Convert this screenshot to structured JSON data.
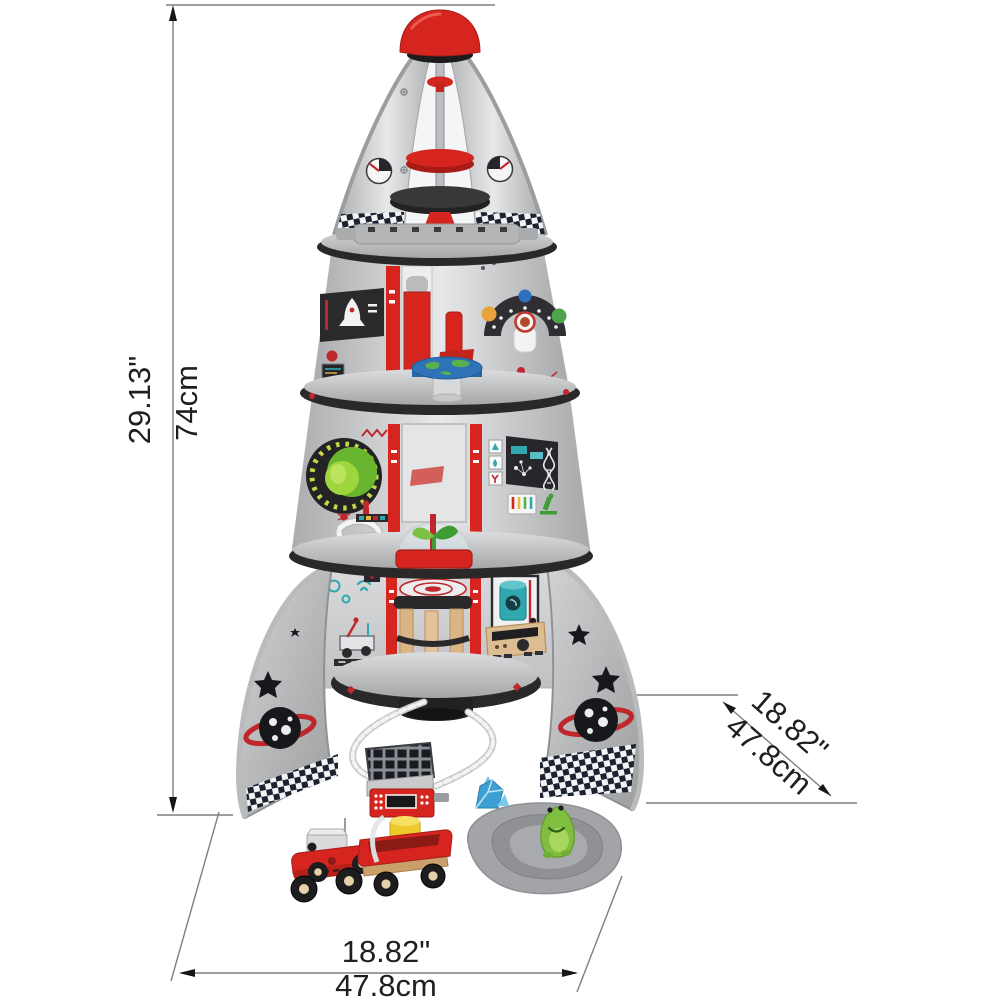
{
  "figure": {
    "subject": "four-stage rocket ship toy with accessories",
    "view": "front product view with engineering dimension callouts"
  },
  "annotations": {
    "height": {
      "inches": "29.13\"",
      "cm": "74cm"
    },
    "width": {
      "inches": "18.82\"",
      "cm": "47.8cm"
    },
    "depth": {
      "inches": "18.82\"",
      "cm": "47.8cm"
    }
  },
  "colors": {
    "accent_red": "#d6251f",
    "silver": "#c6c8ca",
    "dark_trim": "#2b2829",
    "wood": "#d9b586",
    "teal": "#2fa8b0",
    "alien_green": "#7fbe3e",
    "knob_green": "#8cc63e",
    "earth_blue": "#2e73b8",
    "barrel_yellow": "#edc92c",
    "crystal_blue": "#3e9fd4",
    "terrain_gray": "#a2a4a7",
    "dimension_line": "#7d7f81",
    "background": "#ffffff"
  }
}
